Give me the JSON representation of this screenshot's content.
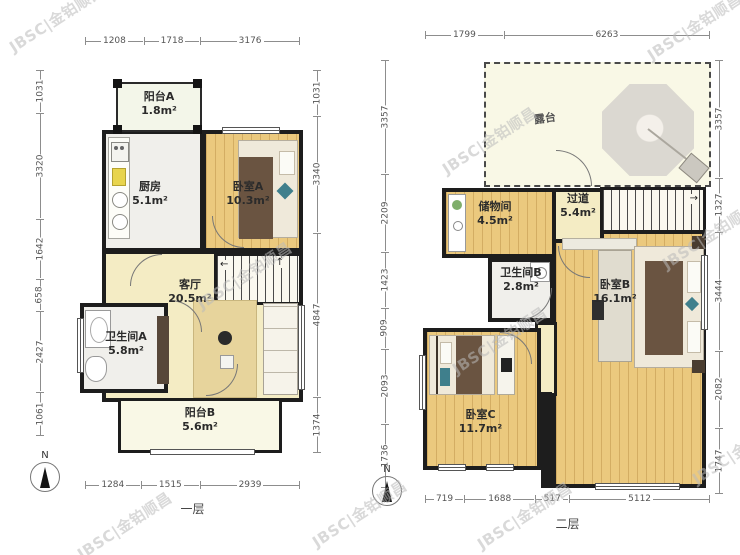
{
  "watermark": {
    "text": "JBSC|金铂顺昌"
  },
  "floor1": {
    "label": "一层",
    "north_label": "N",
    "dims_top": [
      "1208",
      "1718",
      "3176"
    ],
    "dims_left": [
      "1031",
      "3320",
      "1642",
      "658",
      "2427",
      "1061"
    ],
    "dims_right": [
      "1031",
      "3340",
      "4847",
      "1374"
    ],
    "dims_bottom": [
      "1284",
      "1515",
      "2939"
    ],
    "rooms": [
      {
        "name": "阳台A",
        "area": "1.8m²"
      },
      {
        "name": "厨房",
        "area": "5.1m²"
      },
      {
        "name": "卧室A",
        "area": "10.3m²"
      },
      {
        "name": "客厅",
        "area": "20.5m²"
      },
      {
        "name": "卫生间A",
        "area": "5.8m²"
      },
      {
        "name": "阳台B",
        "area": "5.6m²"
      }
    ]
  },
  "floor2": {
    "label": "二层",
    "north_label": "N",
    "dims_top": [
      "1799",
      "6263"
    ],
    "dims_left": [
      "3357",
      "2209",
      "1423",
      "909",
      "2093",
      "1736"
    ],
    "dims_right": [
      "3357",
      "1327",
      "3444",
      "2082",
      "1747"
    ],
    "dims_bottom": [
      "719",
      "1688",
      "517",
      "5112"
    ],
    "rooms": [
      {
        "name": "露台",
        "area": ""
      },
      {
        "name": "储物间",
        "area": "4.5m²"
      },
      {
        "name": "过道",
        "area": "5.4m²"
      },
      {
        "name": "卫生间B",
        "area": "2.8m²"
      },
      {
        "name": "卧室B",
        "area": "16.1m²"
      },
      {
        "name": "卧室C",
        "area": "11.7m²"
      }
    ]
  }
}
